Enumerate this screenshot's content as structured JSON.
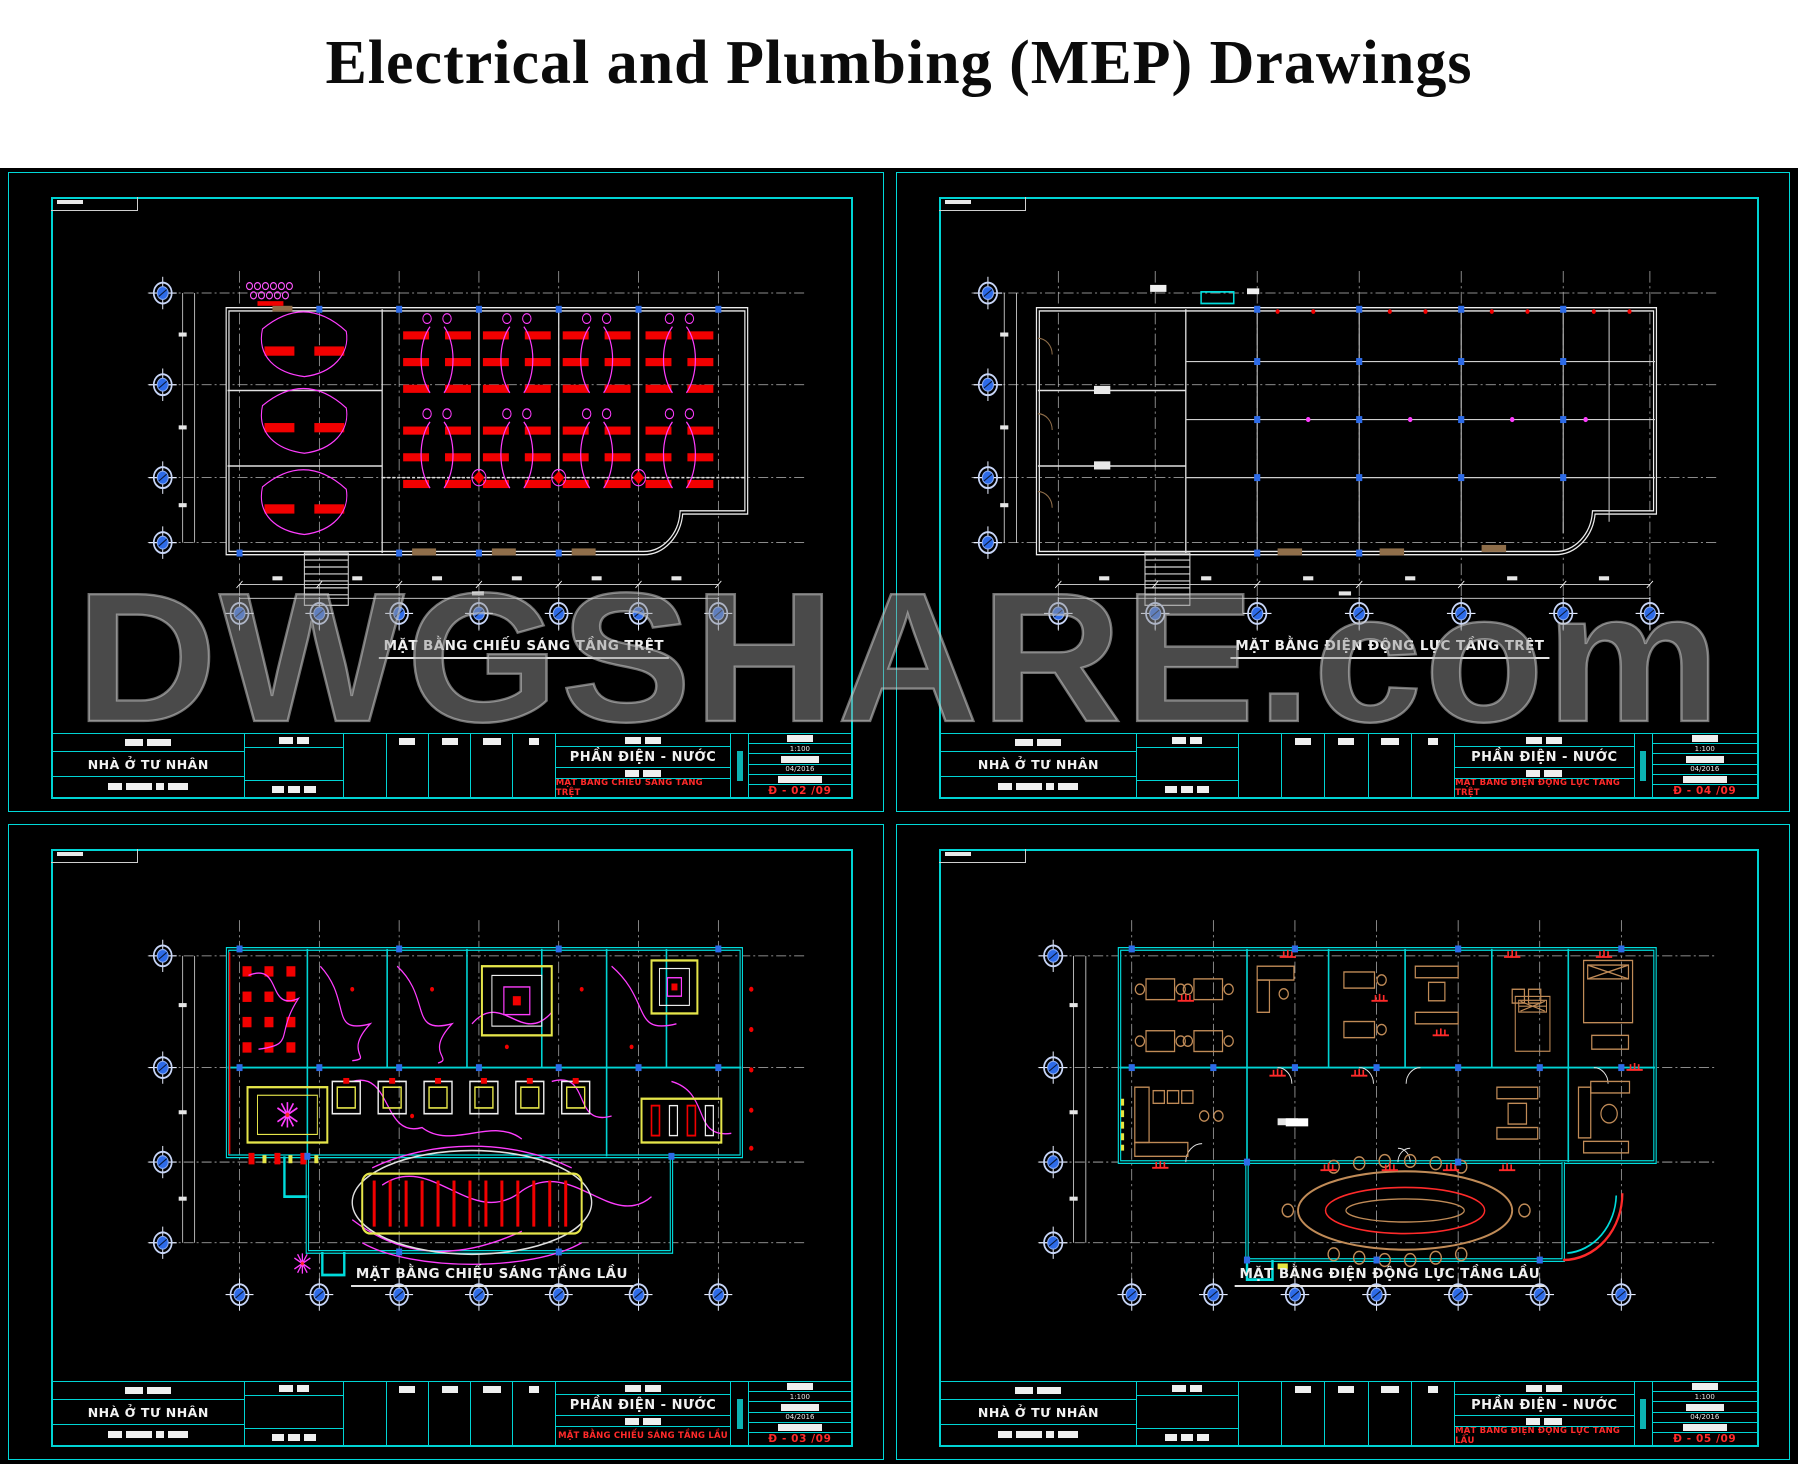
{
  "page": {
    "title": "Electrical and Plumbing (MEP) Drawings"
  },
  "watermark": {
    "text": "DWGSHARE.com"
  },
  "colors": {
    "sheet_background": "#000000",
    "border_cyan": "#00d4d4",
    "wall_white": "#ececec",
    "wall_cyan": "#00dcdc",
    "fixture_red": "#f20000",
    "wiring_magenta": "#ff3dff",
    "grid_bubble_blue": "#2d6be8",
    "furniture_tan": "#c08b57",
    "feature_yellow": "#e6e64a",
    "watermark_gray": "#949494",
    "title_red": "#ff2a2a"
  },
  "sheets": [
    {
      "id": "lighting-ground-floor",
      "plan_label": "MẶT BẰNG CHIẾU SÁNG TẦNG TRỆT",
      "title_block": {
        "project": "NHÀ Ở TƯ NHÂN",
        "section": "PHẦN ĐIỆN - NƯỚC",
        "drawing_name": "MẶT BẰNG CHIẾU SÁNG TẦNG TRỆT",
        "scale": "1:100",
        "date": "04/2016",
        "sheet_no": "Đ - 02 /09"
      }
    },
    {
      "id": "power-ground-floor",
      "plan_label": "MẶT BẰNG ĐIỆN ĐỘNG LỰC TẦNG TRỆT",
      "title_block": {
        "project": "NHÀ Ở TƯ NHÂN",
        "section": "PHẦN ĐIỆN - NƯỚC",
        "drawing_name": "MẶT BẰNG ĐIỆN ĐỘNG LỰC TẦNG TRỆT",
        "scale": "1:100",
        "date": "04/2016",
        "sheet_no": "Đ - 04 /09"
      }
    },
    {
      "id": "lighting-upper-floor",
      "plan_label": "MẶT BẰNG CHIẾU SÁNG TẦNG LẦU",
      "title_block": {
        "project": "NHÀ Ở TƯ NHÂN",
        "section": "PHẦN ĐIỆN - NƯỚC",
        "drawing_name": "MẶT BẰNG CHIẾU SÁNG TẦNG LẦU",
        "scale": "1:100",
        "date": "04/2016",
        "sheet_no": "Đ - 03 /09"
      }
    },
    {
      "id": "power-upper-floor",
      "plan_label": "MẶT BẰNG ĐIỆN ĐỘNG LỰC TẦNG LẦU",
      "title_block": {
        "project": "NHÀ Ở TƯ NHÂN",
        "section": "PHẦN ĐIỆN - NƯỚC",
        "drawing_name": "MẶT BẰNG ĐIỆN ĐỘNG LỰC TẦNG LẦU",
        "scale": "1:100",
        "date": "04/2016",
        "sheet_no": "Đ - 05 /09"
      }
    }
  ]
}
